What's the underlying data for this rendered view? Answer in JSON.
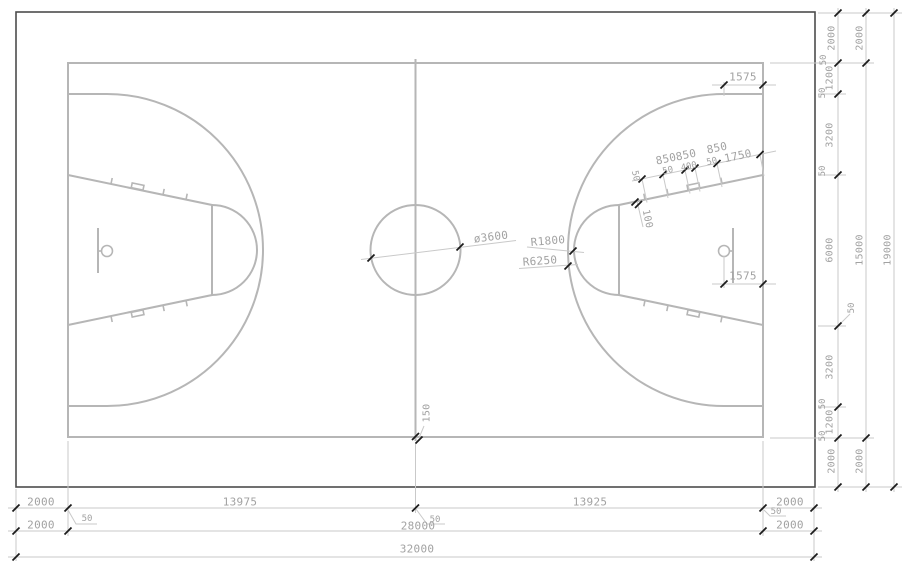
{
  "dims": {
    "bottom": {
      "row1": [
        "2000",
        "13975",
        "13925",
        "2000"
      ],
      "row2": [
        "2000",
        "28000",
        "2000"
      ],
      "leaders": [
        "50",
        "50",
        "50"
      ],
      "total": "32000"
    },
    "right": {
      "col1": [
        "2000",
        "50",
        "1200",
        "50",
        "3200",
        "50",
        "6000",
        "50",
        "3200",
        "50",
        "1200",
        "50",
        "2000"
      ],
      "col2": [
        "2000",
        "15000",
        "2000"
      ],
      "total": "19000"
    },
    "court": {
      "center_circle_diameter": "ø3600",
      "free_throw_radius": "R1800",
      "three_point_radius": "R6250",
      "three_point_straight": "1575",
      "basket_to_endline": "1575",
      "center_line_extension": "150"
    },
    "lane": {
      "above": [
        "850",
        "850",
        "850",
        "1750"
      ],
      "inner": [
        "50",
        "400",
        "50"
      ],
      "start": "50",
      "hash": "100"
    }
  }
}
